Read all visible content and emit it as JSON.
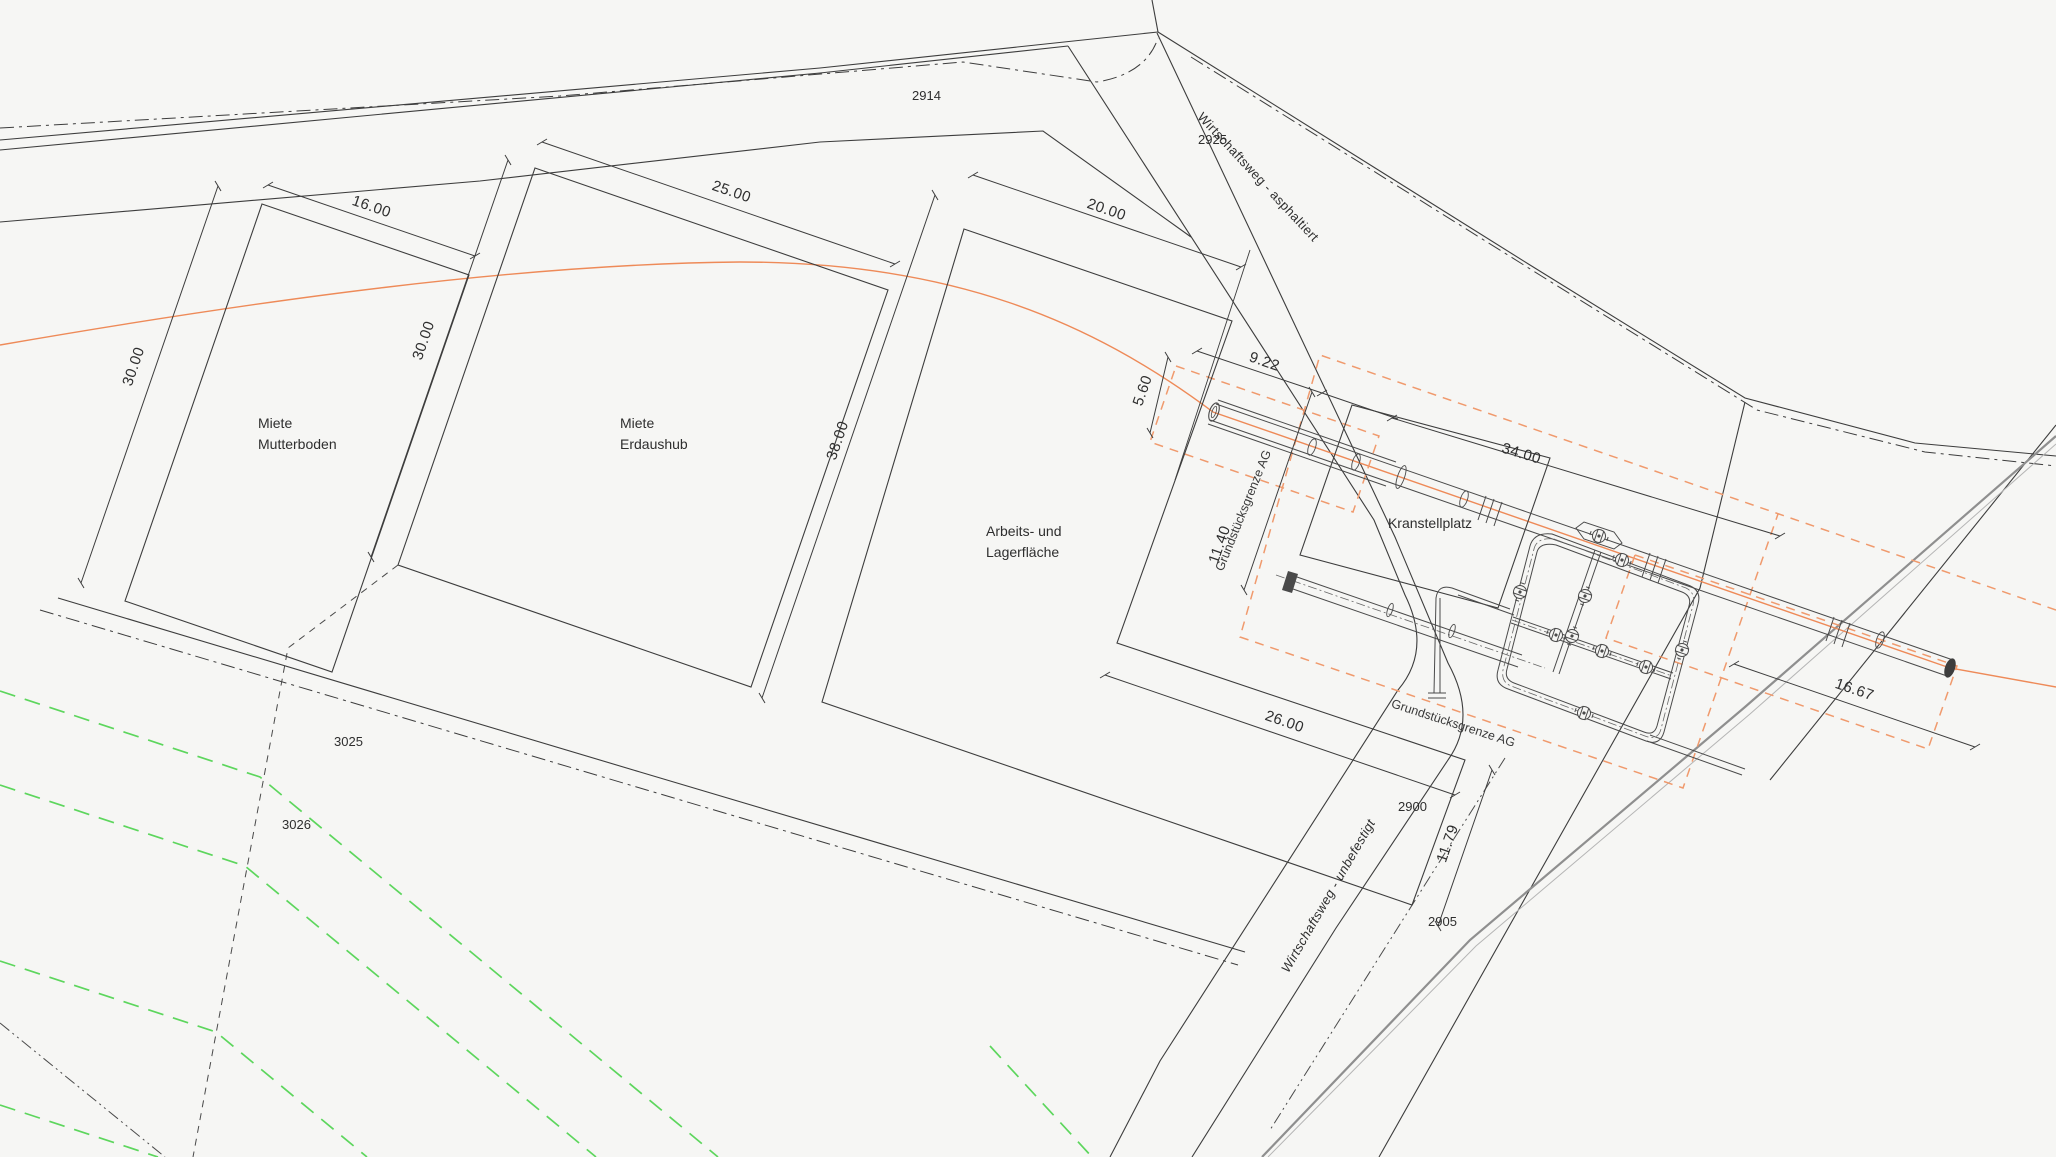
{
  "drawing": {
    "background": "#f6f6f4",
    "colors": {
      "line": "#3d3d3d",
      "orange_boundary": "#ee8a58",
      "green_field": "#5dd65d",
      "gray_pipeline": "#8f8f8f"
    },
    "parcels": {
      "p2914": "2914",
      "p2925": "2925",
      "p2900": "2900",
      "p2905": "2905",
      "p3025": "3025",
      "p3026": "3026"
    },
    "areas": {
      "mutterboden": {
        "line1": "Miete",
        "line2": "Mutterboden"
      },
      "erdaushub": {
        "line1": "Miete",
        "line2": "Erdaushub"
      },
      "lager": {
        "line1": "Arbeits- und",
        "line2": "Lagerfläche"
      },
      "kran": {
        "label": "Kranstellplatz"
      }
    },
    "roads": {
      "asphaltiert": "Wirtschaftsweg - asphaltiert",
      "unbefestigt": "Wirtschaftsweg - unbefestigt"
    },
    "boundary": {
      "label": "Grundstücksgrenze AG"
    },
    "dims": {
      "d16": "16.00",
      "d30a": "30.00",
      "d30b": "30.00",
      "d25": "25.00",
      "d20": "20.00",
      "d38": "38.00",
      "d26": "26.00",
      "d1179": "11.79",
      "d922": "9.22",
      "d560": "5.60",
      "d1140": "11.40",
      "d34": "34.00",
      "d1667": "16.67"
    }
  }
}
